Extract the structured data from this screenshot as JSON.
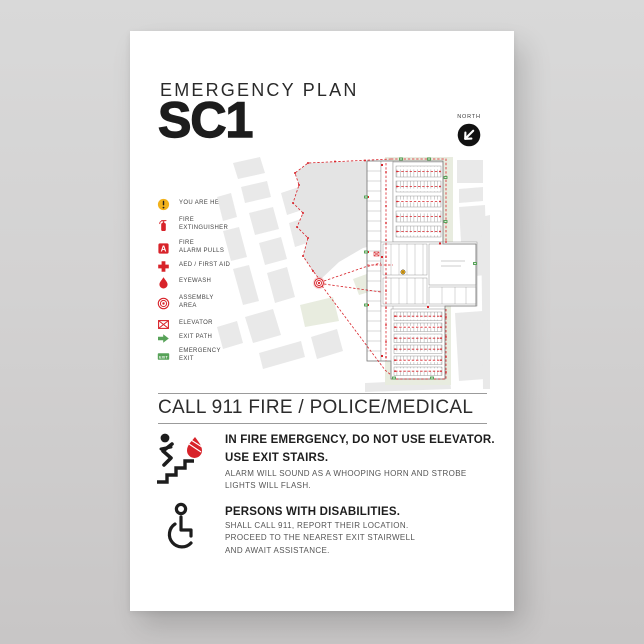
{
  "colors": {
    "red": "#d8232a",
    "green": "#57a258",
    "yellow": "#f2b21c",
    "ink": "#1d1d1d",
    "wall": "#8f8f8f",
    "map_block": "#e9e9e9",
    "map_green": "#e8ecdf",
    "map_blob": "#e4e4e4"
  },
  "header": {
    "eyebrow": "EMERGENCY PLAN",
    "code": "SC1"
  },
  "compass": {
    "label": "NORTH"
  },
  "legend": {
    "alarm_letter": "A",
    "exit_text": "EXIT",
    "items": [
      {
        "label": "YOU ARE HERE"
      },
      {
        "label": "FIRE\nEXTINGUISHER"
      },
      {
        "label": "FIRE\nALARM PULLS"
      },
      {
        "label": "AED / FIRST AID"
      },
      {
        "label": "EYEWASH"
      },
      {
        "label": "ASSEMBLY\nAREA"
      },
      {
        "label": "ELEVATOR"
      },
      {
        "label": "EXIT PATH"
      },
      {
        "label": "EMERGENCY\nEXIT"
      }
    ]
  },
  "call_banner": {
    "text": "CALL 911 FIRE / POLICE/MEDICAL"
  },
  "fire_section": {
    "heading": "IN FIRE EMERGENCY, DO NOT USE ELEVATOR.\nUSE EXIT STAIRS.",
    "body": "ALARM WILL SOUND AS A WHOOPING HORN AND STROBE\nLIGHTS WILL FLASH."
  },
  "pwd_section": {
    "heading": "PERSONS WITH DISABILITIES.",
    "body": "SHALL CALL 911, REPORT THEIR LOCATION.\nPROCEED TO THE NEAREST EXIT STAIRWELL\nAND AWAIT ASSISTANCE."
  }
}
